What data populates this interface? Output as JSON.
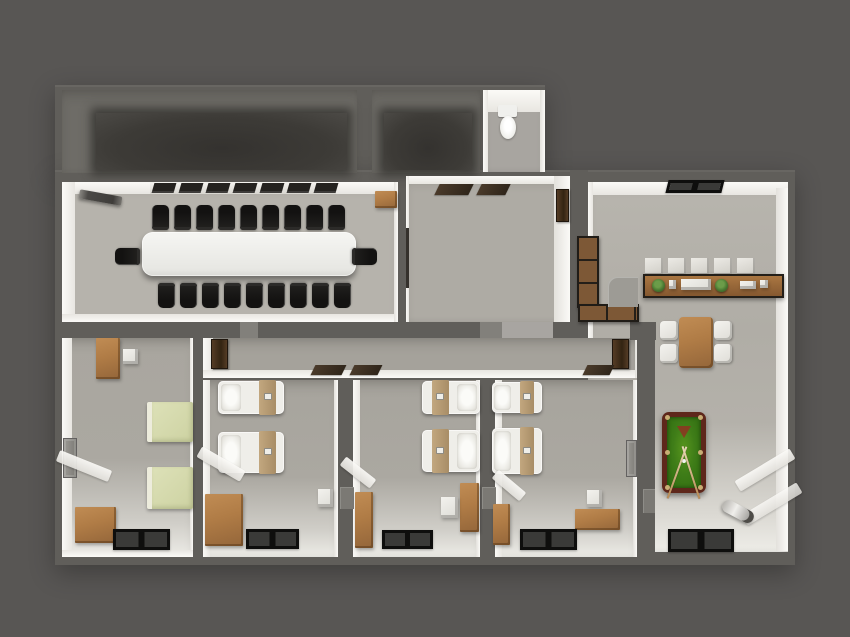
{
  "scene": {
    "title": "3D rendered office floor plan, top-down view",
    "style": "architectural 3D render, no visible text",
    "background": "dark warm gray"
  },
  "colors": {
    "bg": "#585654",
    "wall": "#605e5a",
    "wall-light": "#82807b",
    "face": "#f2f1ed",
    "floor-conf": "#b6b3ac",
    "floor-entry": "#aeaba4",
    "floor-corr": "#a5a29b",
    "floor-bed": "#a8a59e",
    "floor-right": "#b3b0a9",
    "floor-dark": "#3f3d39",
    "floor-bath": "#a8a5a0",
    "table-white": "#eeeeea",
    "chair-black": "#1a1917",
    "wood-light": "#c08c54",
    "wood-dark": "#94663a",
    "bed-white": "#efeee9",
    "bed-tan": "#b79c76",
    "bed-green": "#d6daae",
    "mat-dark": "#1c1c1b",
    "mat-brown": "#3e3023",
    "door-brown": "#46321f",
    "pool-rim": "#5e271b",
    "pool-felt": "#3f7d18",
    "plant": "#4e7c33",
    "gray-item": "#9d9b95",
    "radiator": "#8b8984",
    "chrome": "#e8e7e3"
  },
  "counts": {
    "conference_chairs_top": 9,
    "conference_chairs_bottom": 9,
    "conference_end_chairs": 2,
    "cubby_boxes": 5,
    "window_vent_slats": 7,
    "dining_chairs": 4,
    "bedrooms_with_white_beds": 3
  },
  "rooms": [
    {
      "name": "storage-room-large",
      "type": "unlit room",
      "furniture": []
    },
    {
      "name": "storage-room-small",
      "type": "unlit room",
      "furniture": []
    },
    {
      "name": "bathroom",
      "furniture": [
        "toilet"
      ]
    },
    {
      "name": "conference-room",
      "furniture": [
        "long white conference table",
        "20 black office chairs",
        "projector screen",
        "wall-mounted wood shelf",
        "window vent strip"
      ]
    },
    {
      "name": "entry-hall",
      "furniture": [
        "two brown floor mats",
        "brown wall door",
        "open door leaf"
      ]
    },
    {
      "name": "common-room",
      "furniture": [
        "black doormat at entrance",
        "wardrobe with metal frame",
        "white cubby shelf",
        "wood sideboard with two plants",
        "dining table",
        "four white chairs",
        "green billiard table with cues and rack",
        "chrome radiator",
        "black doormat at bottom"
      ]
    },
    {
      "name": "corridor",
      "furniture": [
        "two open brown doors",
        "three brown mats"
      ]
    },
    {
      "name": "office-bedroom-left",
      "furniture": [
        "wood desk",
        "white chair cube",
        "wall radiator",
        "two green beds",
        "wood cabinet",
        "black doormat"
      ]
    },
    {
      "name": "bedroom-1",
      "furniture": [
        "two white beds with tan blankets",
        "white nightstand",
        "wood cabinet",
        "black doormat",
        "white wall ledge"
      ]
    },
    {
      "name": "bedroom-2",
      "furniture": [
        "two white beds with tan blankets",
        "white nightstand",
        "two wood cabinets",
        "black doormat",
        "white wall ledge"
      ]
    },
    {
      "name": "bedroom-3",
      "furniture": [
        "two white beds with tan blankets",
        "white nightstand",
        "wood cabinet",
        "wood dresser",
        "wall radiator",
        "black doormat",
        "white wall ledge"
      ]
    }
  ]
}
